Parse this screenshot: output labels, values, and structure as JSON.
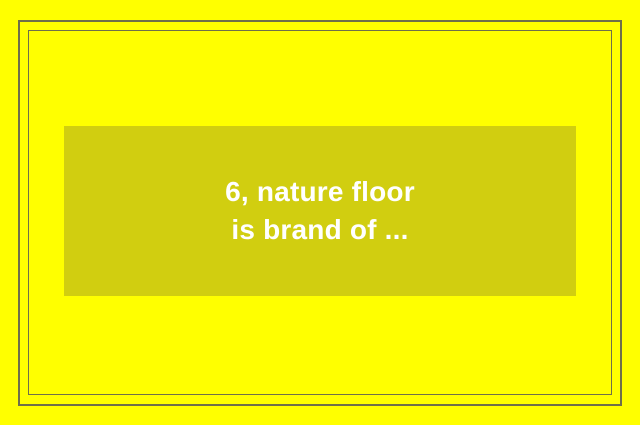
{
  "page": {
    "background_color": "#ffff00",
    "frame_border_color": "#6f6f4a"
  },
  "card": {
    "background_color": "#d1ce10",
    "text_color": "#ffffff",
    "line1": "6, nature floor",
    "line2": "is brand of ..."
  }
}
